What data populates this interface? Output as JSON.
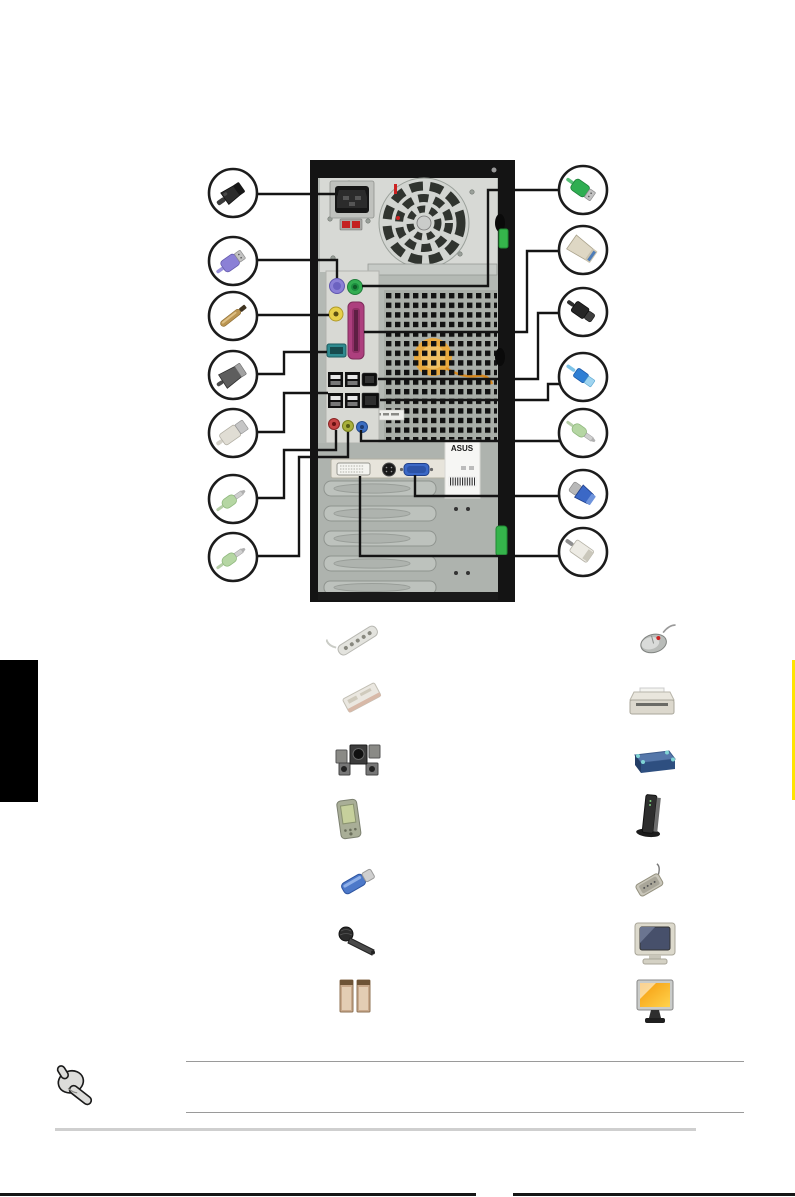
{
  "page": {
    "type": "hardware-manual-rear-panel-page",
    "background_color": "#ffffff",
    "chapter_tab_color": "#000000",
    "edge_marker_color": "#ffe400"
  },
  "rear_panel_diagram": {
    "description": "desktop-tower-rear-view-with-connector-callouts",
    "chassis": {
      "body_color": "#b4b9b4",
      "frame_color": "#141414",
      "psu_color": "#d7d9d5",
      "clip_color": "#35b44b",
      "fan_badge_color": "#e9a93e",
      "sticker_label": "ASUS"
    },
    "ports": [
      {
        "name": "power-connector",
        "color": "#161616"
      },
      {
        "name": "ps2-keyboard-port",
        "color": "#8b80d6"
      },
      {
        "name": "ps2-mouse-port",
        "color": "#33ad52"
      },
      {
        "name": "spdif-out-port",
        "color": "#e6cf4a"
      },
      {
        "name": "parallel-port",
        "color": "#ad3f7e"
      },
      {
        "name": "serial-port",
        "color": "#2f8b90"
      },
      {
        "name": "usb-ports",
        "color": "#111111"
      },
      {
        "name": "ieee1394-port",
        "color": "#0d0d0d"
      },
      {
        "name": "lan-port",
        "color": "#0d0d0d"
      },
      {
        "name": "mic-jack",
        "color": "#c44444"
      },
      {
        "name": "line-out-jack",
        "color": "#a9b03c"
      },
      {
        "name": "line-in-jack",
        "color": "#3a6dc2"
      },
      {
        "name": "dvi-port",
        "color": "#f4f4f0"
      },
      {
        "name": "s-video-port",
        "color": "#191919"
      },
      {
        "name": "vga-port",
        "color": "#3b68c6"
      }
    ],
    "callouts_left": [
      {
        "connector": "power-cord-plug",
        "color": "#2c2c2c"
      },
      {
        "connector": "ps2-keyboard-plug",
        "color": "#8b80d6"
      },
      {
        "connector": "coaxial-spdif-plug",
        "color": "#bb9551"
      },
      {
        "connector": "serial-db9-plug",
        "color": "#5e5e5e"
      },
      {
        "connector": "usb-plug",
        "color": "#e0ddd4"
      },
      {
        "connector": "audio-jack-plug",
        "color": "#b5d6a3"
      },
      {
        "connector": "audio-jack-plug",
        "color": "#b5d6a3"
      }
    ],
    "callouts_right": [
      {
        "connector": "ps2-mouse-plug",
        "color": "#2fae52"
      },
      {
        "connector": "parallel-plug",
        "color": "#ded7c4"
      },
      {
        "connector": "ieee1394-plug",
        "color": "#262626"
      },
      {
        "connector": "usb-plug",
        "color": "#2f7fd4"
      },
      {
        "connector": "audio-jack-plug",
        "color": "#b5d6a3"
      },
      {
        "connector": "vga-plug",
        "color": "#3b68c6"
      },
      {
        "connector": "dvi-plug",
        "color": "#edebe4"
      }
    ]
  },
  "peripherals": {
    "left_column": [
      "power-strip",
      "modem-card",
      "surround-speaker-set",
      "pda",
      "usb-flash-drive",
      "microphone",
      "stereo-speakers"
    ],
    "right_column": [
      "mouse",
      "printer",
      "external-drive",
      "modem-router",
      "portable-media-device",
      "crt-monitor",
      "lcd-monitor"
    ]
  },
  "note": {
    "icon": "pointing-hand-icon",
    "rules": 2,
    "text": ""
  }
}
